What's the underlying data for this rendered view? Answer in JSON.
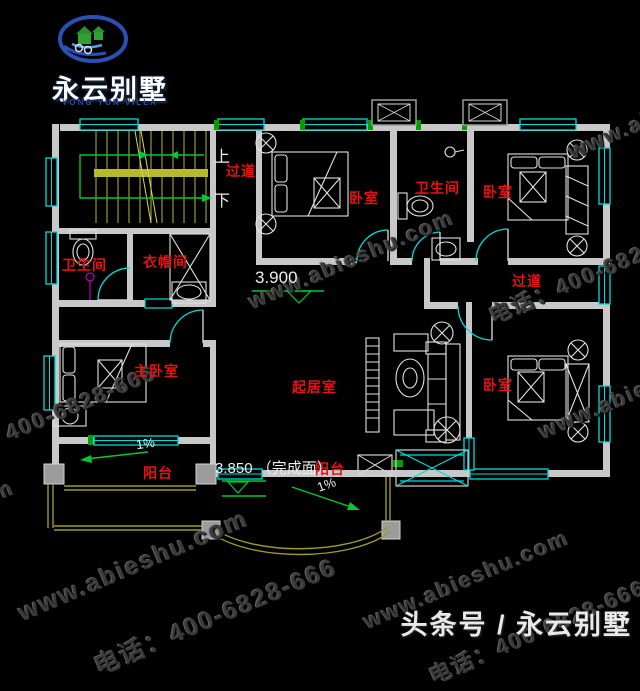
{
  "page": {
    "background": "#000000",
    "width": 640,
    "height": 643
  },
  "logo": {
    "brand": "永云别墅",
    "brand_en": "YONG YUN VILLA"
  },
  "watermark": {
    "site": "www.abieshu.com",
    "phone": "电话：400-6828-666"
  },
  "footer": {
    "text": "头条号 / 永云别墅"
  },
  "plan": {
    "room_labels": [
      {
        "id": "corridor-top",
        "label": "过道"
      },
      {
        "id": "bedroom-top",
        "label": "卧室"
      },
      {
        "id": "bathroom-top",
        "label": "卫生间"
      },
      {
        "id": "bedroom-top-right",
        "label": "卧室"
      },
      {
        "id": "bathroom-left",
        "label": "卫生间"
      },
      {
        "id": "cloakroom",
        "label": "衣帽间"
      },
      {
        "id": "corridor-right",
        "label": "过道"
      },
      {
        "id": "master-bedroom",
        "label": "主卧室"
      },
      {
        "id": "living-room",
        "label": "起居室"
      },
      {
        "id": "bedroom-bottom-right",
        "label": "卧室"
      },
      {
        "id": "balcony-left",
        "label": "阳台"
      },
      {
        "id": "balcony-front",
        "label": "阳台"
      }
    ],
    "stair_up": "上",
    "stair_down": "下",
    "level_upper": "3.900",
    "level_balcony": "3.850 （完成面）",
    "slope_left": "1%",
    "slope_front": "1%",
    "colors": {
      "wall": "#c8c8c8",
      "window": "#00dcdc",
      "room_label": "#e81212",
      "stair": "#b8b832",
      "railing": "#9a9a2e",
      "green": "#00c832",
      "shower": "#cc00cc",
      "furniture": "#e2e2e2"
    }
  }
}
